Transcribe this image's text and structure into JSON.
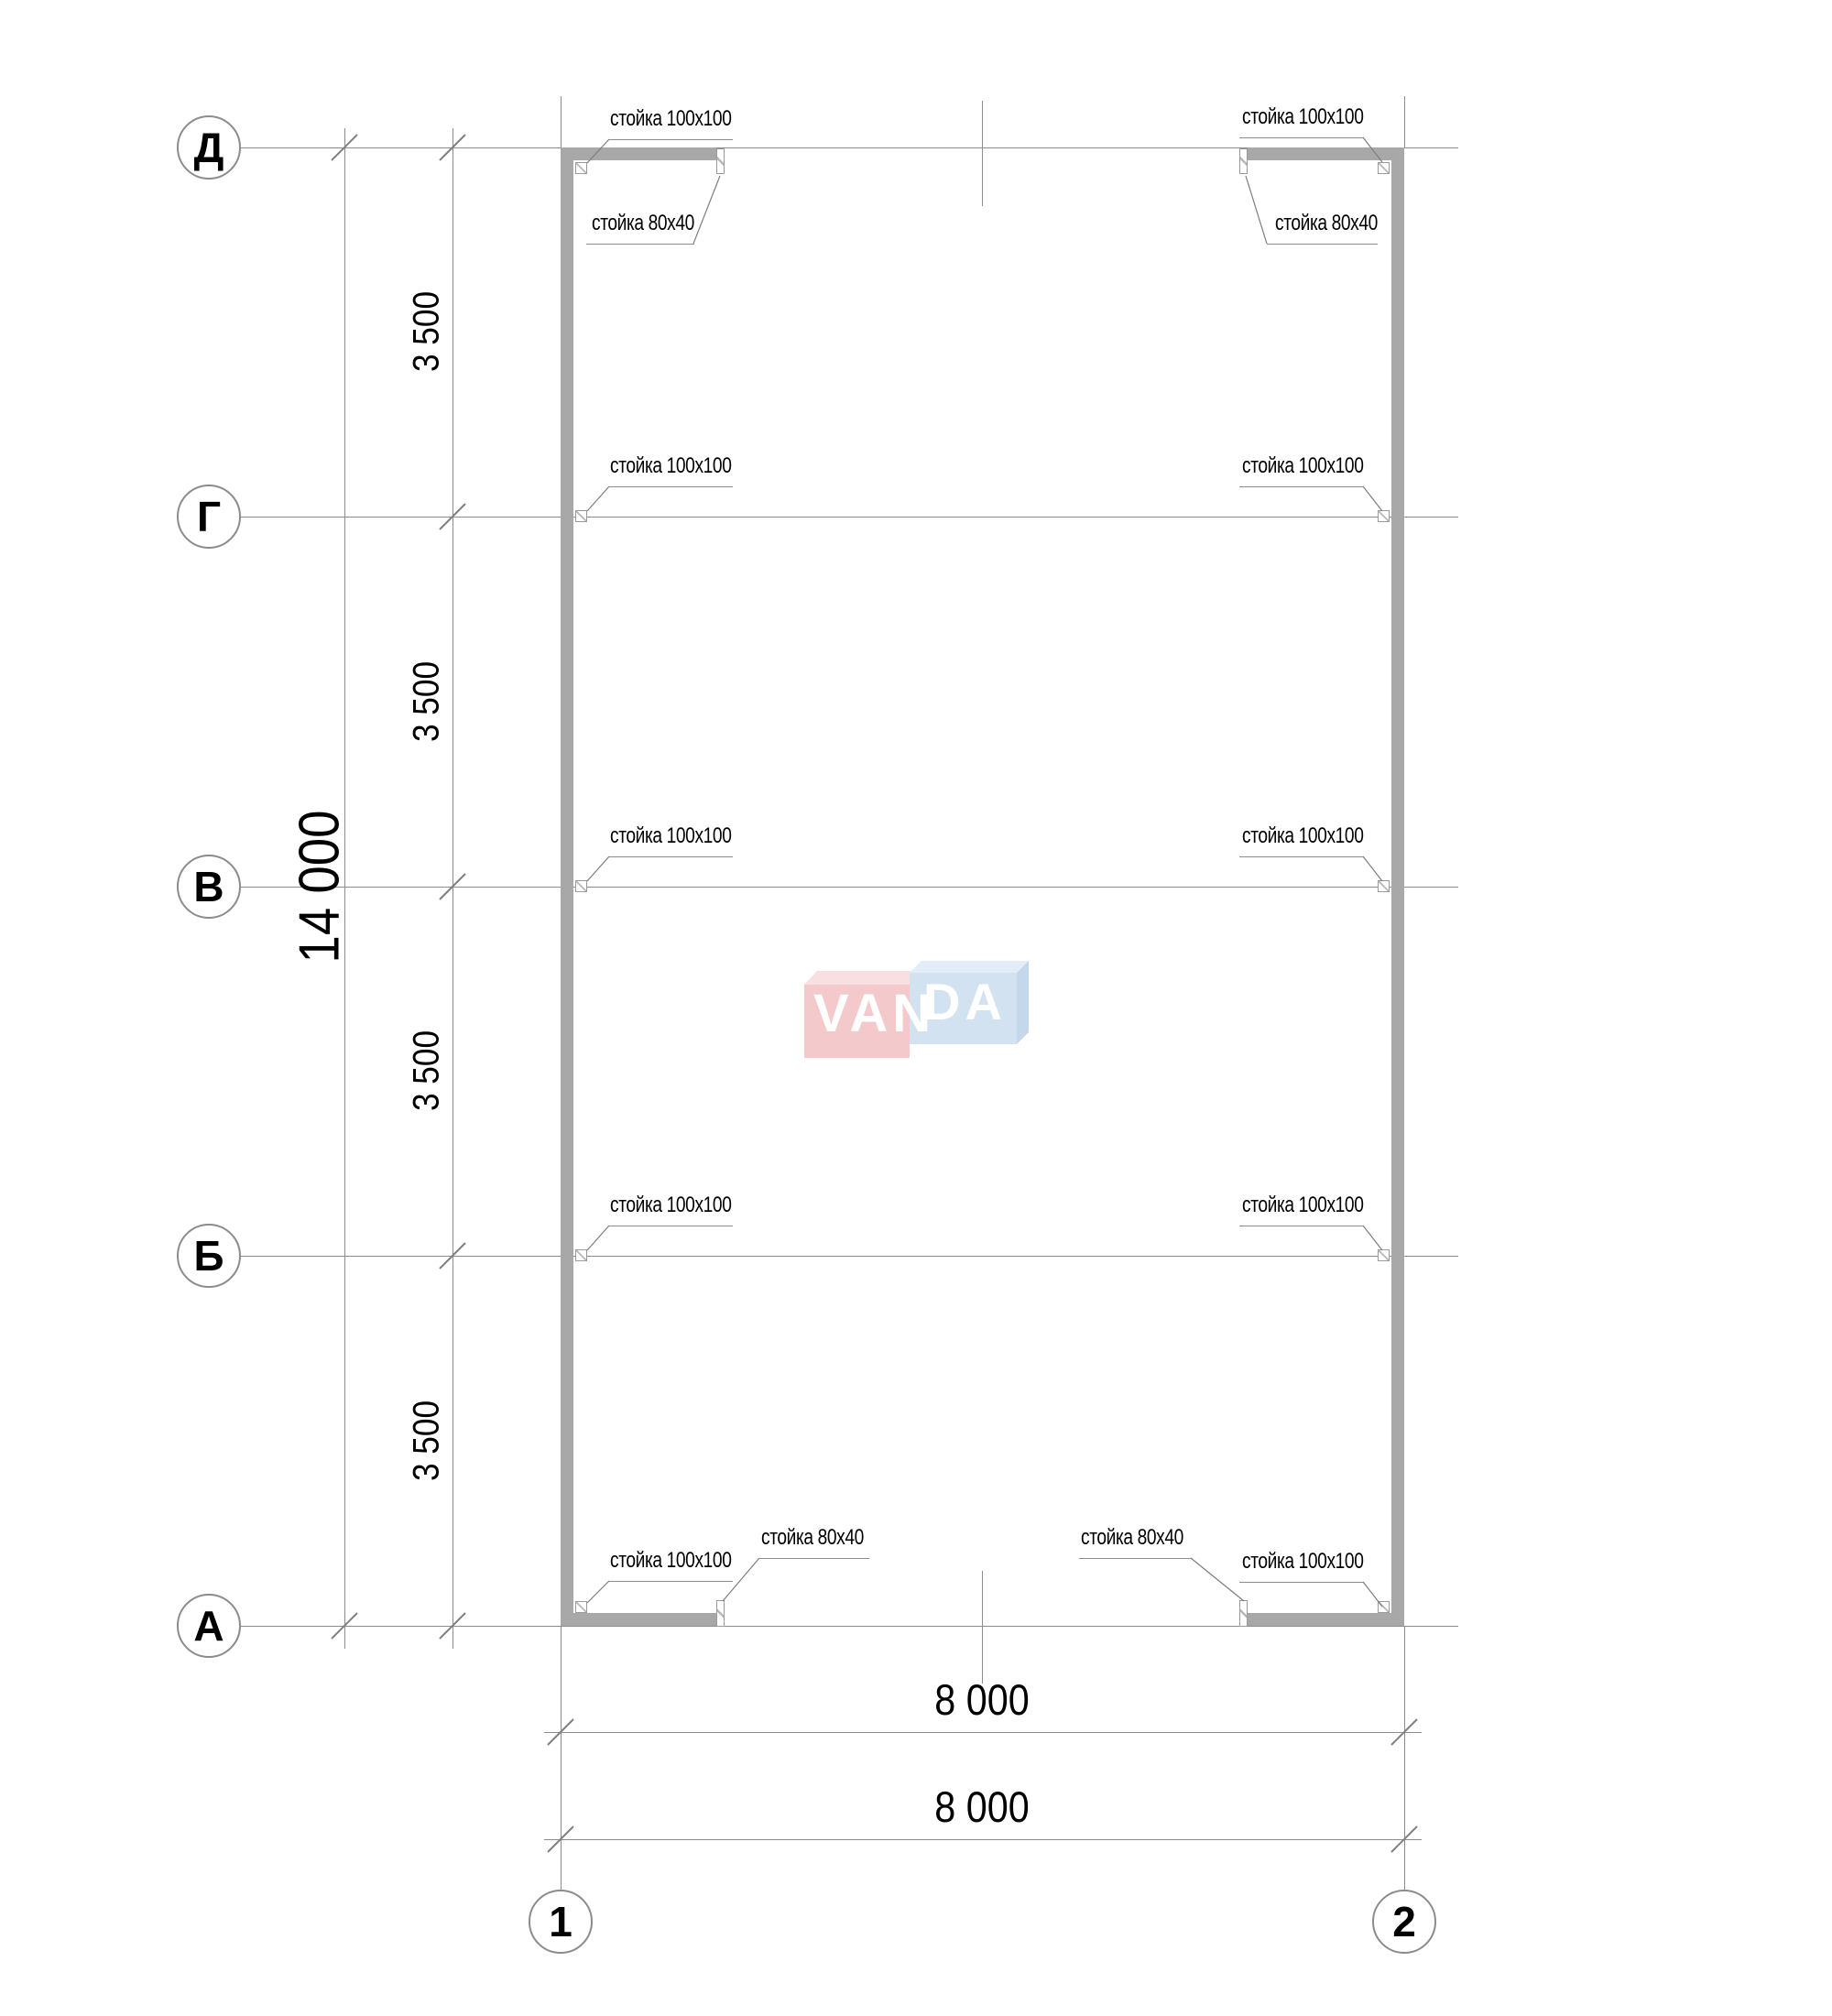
{
  "axes": {
    "rows": [
      {
        "label": "Д"
      },
      {
        "label": "Г"
      },
      {
        "label": "В"
      },
      {
        "label": "Б"
      },
      {
        "label": "А"
      }
    ],
    "cols": [
      {
        "label": "1"
      },
      {
        "label": "2"
      }
    ]
  },
  "dimensions": {
    "total_height": "14 000",
    "bay_spacing": "3 500",
    "total_width": "8 000"
  },
  "labels": {
    "post_100": "стойка 100x100",
    "post_80": "стойка 80x40"
  },
  "watermark": {
    "left": "VAN",
    "right": "DA"
  },
  "colors": {
    "wall": "#a8a8a8",
    "line": "#8c8c8c",
    "logo_pink": "#f2c0c4",
    "logo_blue": "#ccddef"
  }
}
